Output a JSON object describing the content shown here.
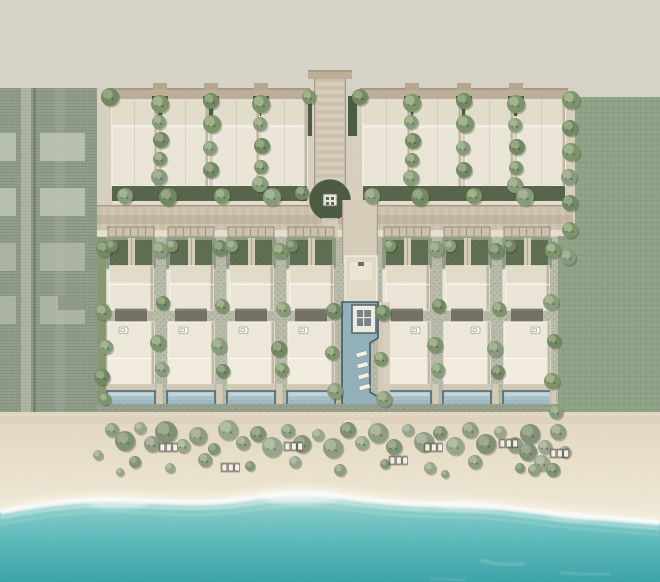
{
  "meta": {
    "view": "aerial-site-plan",
    "subject": "beachfront-villa-resort-masterplan"
  },
  "palette": {
    "land": "#d8d4ca",
    "siteGround": "#d8d0be",
    "gravel": "#9ea795",
    "parcelGround": "#919e8c",
    "parcelRoad": "#c3c8b7",
    "parcelSlab": "#bcc3b2",
    "lawn": "#8ea388",
    "lawnStrip": "#7f9463",
    "hedge": "#46573c",
    "garden": "#5a6b4c",
    "road": "#d0c7b3",
    "roadStripe": "#c3b8a1",
    "roadDark": "#aa9e88",
    "walk": "#e9e4d5",
    "canopy": "#bcae96",
    "canopyDark": "#a6987e",
    "building": "#ece7d8",
    "buildingDark": "#e2dbc8",
    "buildingEdge": "#f9f6ef",
    "buildingShadow": "#b5aa95",
    "court": "#57544a",
    "pergola": "#cdc1a8",
    "deck": "#d6cdba",
    "pool": "#a6c1ca",
    "poolLight": "#c9dce0",
    "poolEdge": "#3f5460",
    "mainPool": "#8fb0ba",
    "sandTop": "#e3d8c2",
    "sandMid": "#ebe3cd",
    "sandLight": "#f1ead8",
    "shoreTint": "#dbc9b2",
    "foam": "#ffffff",
    "oceanShallow": "#b7dcd6",
    "ocean1": "#7ac9c6",
    "ocean2": "#55b8ba",
    "oceanDeep": "#37a2a8",
    "treeA": "#7b9168",
    "treeB": "#86997b",
    "treeC": "#6e8560",
    "treeHi": "#a9bc93",
    "bushA": "#8c9b80",
    "bushB": "#96a38b",
    "bushC": "#7e8f73",
    "loungerWhite": "#f4f2ea",
    "loungerFrame": "#55534a"
  },
  "scene": {
    "top_row": {
      "y": 100,
      "h": 86,
      "left": {
        "xs": [
          112,
          163,
          214,
          262
        ],
        "w": 45,
        "gaps": [
          160,
          211,
          261
        ]
      },
      "right": {
        "xs": [
          363,
          414,
          466,
          518
        ],
        "w": 47,
        "gaps": [
          412,
          464,
          516
        ]
      }
    },
    "villas": {
      "lefts": [
        106,
        166,
        226,
        286
      ],
      "rights": [
        382,
        442,
        502
      ],
      "w": 50,
      "boundary_walks": [
        159.5,
        219.5,
        279.5,
        435.5,
        495.5,
        553
      ]
    },
    "left_parcel": {
      "slab_cols": [
        {
          "x": 0,
          "w": 16
        },
        {
          "x": 40,
          "w": 45
        }
      ],
      "slab_rows": [
        133,
        188,
        243,
        296
      ],
      "slab_h": 28
    },
    "trees": [
      [
        160,
        104,
        9
      ],
      [
        159,
        122,
        7
      ],
      [
        161,
        140,
        8
      ],
      [
        160,
        159,
        7
      ],
      [
        159,
        177,
        8
      ],
      [
        211,
        101,
        8
      ],
      [
        212,
        124,
        9
      ],
      [
        210,
        148,
        7
      ],
      [
        211,
        170,
        8
      ],
      [
        261,
        104,
        9
      ],
      [
        260,
        124,
        7
      ],
      [
        262,
        146,
        8
      ],
      [
        261,
        167,
        7
      ],
      [
        260,
        184,
        8
      ],
      [
        110,
        97,
        9
      ],
      [
        309,
        97,
        7
      ],
      [
        125,
        196,
        8
      ],
      [
        168,
        197,
        9
      ],
      [
        222,
        196,
        8
      ],
      [
        272,
        197,
        9
      ],
      [
        302,
        193,
        7
      ],
      [
        412,
        103,
        9
      ],
      [
        411,
        122,
        7
      ],
      [
        413,
        141,
        8
      ],
      [
        412,
        160,
        7
      ],
      [
        411,
        178,
        8
      ],
      [
        464,
        101,
        8
      ],
      [
        465,
        124,
        9
      ],
      [
        463,
        148,
        7
      ],
      [
        464,
        170,
        8
      ],
      [
        516,
        104,
        9
      ],
      [
        515,
        125,
        7
      ],
      [
        517,
        147,
        8
      ],
      [
        516,
        168,
        7
      ],
      [
        515,
        185,
        8
      ],
      [
        360,
        97,
        8
      ],
      [
        571,
        100,
        9
      ],
      [
        372,
        196,
        8
      ],
      [
        420,
        197,
        9
      ],
      [
        474,
        196,
        8
      ],
      [
        525,
        197,
        9
      ],
      [
        570,
        128,
        8
      ],
      [
        571,
        152,
        9
      ],
      [
        569,
        177,
        8
      ],
      [
        570,
        203,
        8
      ],
      [
        570,
        230,
        8
      ],
      [
        568,
        257,
        8
      ],
      [
        104,
        249,
        8
      ],
      [
        103,
        312,
        8
      ],
      [
        106,
        347,
        7
      ],
      [
        102,
        377,
        8
      ],
      [
        105,
        399,
        6
      ],
      [
        160,
        250,
        8
      ],
      [
        163,
        303,
        7
      ],
      [
        158,
        343,
        8
      ],
      [
        162,
        369,
        7
      ],
      [
        220,
        248,
        8
      ],
      [
        222,
        306,
        7
      ],
      [
        219,
        346,
        8
      ],
      [
        223,
        371,
        7
      ],
      [
        280,
        251,
        8
      ],
      [
        283,
        309,
        7
      ],
      [
        279,
        349,
        8
      ],
      [
        282,
        370,
        7
      ],
      [
        436,
        249,
        8
      ],
      [
        439,
        306,
        7
      ],
      [
        435,
        345,
        8
      ],
      [
        438,
        370,
        7
      ],
      [
        496,
        251,
        8
      ],
      [
        499,
        309,
        7
      ],
      [
        495,
        349,
        8
      ],
      [
        498,
        372,
        7
      ],
      [
        553,
        250,
        8
      ],
      [
        551,
        302,
        8
      ],
      [
        554,
        341,
        7
      ],
      [
        552,
        381,
        8
      ],
      [
        556,
        412,
        7
      ],
      [
        334,
        311,
        8
      ],
      [
        332,
        353,
        7
      ],
      [
        335,
        391,
        8
      ],
      [
        383,
        313,
        8
      ],
      [
        381,
        359,
        7
      ],
      [
        384,
        399,
        8
      ],
      [
        112,
        246,
        6
      ],
      [
        172,
        246,
        6
      ],
      [
        232,
        246,
        6
      ],
      [
        292,
        246,
        6
      ],
      [
        390,
        246,
        6
      ],
      [
        450,
        246,
        6
      ],
      [
        510,
        246,
        6
      ]
    ],
    "bushes": [
      [
        112,
        430,
        7
      ],
      [
        125,
        441,
        10
      ],
      [
        140,
        428,
        6
      ],
      [
        152,
        444,
        8
      ],
      [
        166,
        432,
        11
      ],
      [
        183,
        446,
        7
      ],
      [
        198,
        436,
        9
      ],
      [
        214,
        449,
        6
      ],
      [
        228,
        430,
        10
      ],
      [
        243,
        443,
        7
      ],
      [
        258,
        434,
        8
      ],
      [
        272,
        447,
        10
      ],
      [
        288,
        431,
        7
      ],
      [
        302,
        444,
        9
      ],
      [
        318,
        435,
        6
      ],
      [
        333,
        448,
        10
      ],
      [
        348,
        430,
        8
      ],
      [
        362,
        443,
        7
      ],
      [
        378,
        433,
        10
      ],
      [
        394,
        447,
        8
      ],
      [
        408,
        430,
        6
      ],
      [
        424,
        442,
        10
      ],
      [
        440,
        433,
        7
      ],
      [
        455,
        446,
        9
      ],
      [
        470,
        430,
        8
      ],
      [
        486,
        444,
        10
      ],
      [
        500,
        432,
        6
      ],
      [
        515,
        445,
        8
      ],
      [
        530,
        434,
        10
      ],
      [
        545,
        447,
        7
      ],
      [
        558,
        432,
        8
      ],
      [
        135,
        462,
        6
      ],
      [
        170,
        468,
        5
      ],
      [
        205,
        460,
        7
      ],
      [
        250,
        466,
        5
      ],
      [
        295,
        462,
        6
      ],
      [
        340,
        470,
        6
      ],
      [
        385,
        464,
        5
      ],
      [
        430,
        468,
        6
      ],
      [
        475,
        462,
        7
      ],
      [
        520,
        468,
        5
      ],
      [
        98,
        455,
        5
      ],
      [
        565,
        452,
        6
      ],
      [
        528,
        452,
        9
      ],
      [
        542,
        463,
        8
      ],
      [
        534,
        470,
        6
      ],
      [
        553,
        470,
        7
      ],
      [
        120,
        472,
        4
      ],
      [
        445,
        474,
        4
      ]
    ],
    "loungers": [
      [
        160,
        444
      ],
      [
        285,
        443
      ],
      [
        222,
        464
      ],
      [
        390,
        457
      ],
      [
        425,
        444
      ],
      [
        500,
        440
      ],
      [
        551,
        450
      ]
    ]
  }
}
